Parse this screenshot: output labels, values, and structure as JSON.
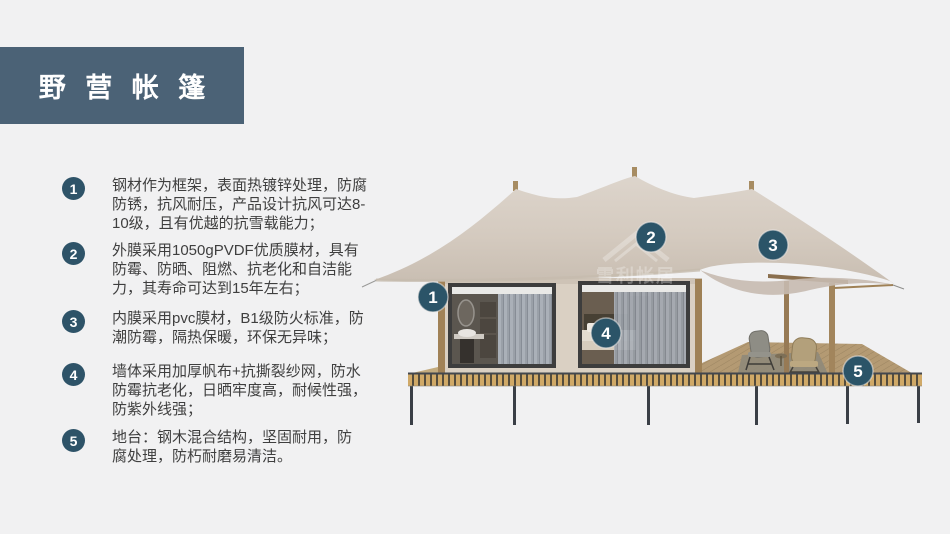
{
  "slide": {
    "title": "野 营 帐 篷",
    "background_color": "#f1f1f2",
    "title_bg_color": "#4b6276",
    "accent_color": "#2e5368"
  },
  "features": [
    {
      "num": "1",
      "text": "钢材作为框架，表面热镀锌处理，防腐\n防锈，抗风耐压，产品设计抗风可达8-\n10级，且有优越的抗雪载能力；"
    },
    {
      "num": "2",
      "text": "外膜采用1050gPVDF优质膜材，具有\n防霉、防晒、阻燃、抗老化和自洁能\n力，其寿命可达到15年左右；"
    },
    {
      "num": "3",
      "text": "内膜采用pvc膜材，B1级防火标准，防\n潮防霉，隔热保暖，环保无异味；"
    },
    {
      "num": "4",
      "text": "墙体采用加厚帆布+抗撕裂纱网，防水\n防霉抗老化，日晒牢度高，耐候性强，\n防紫外线强；"
    },
    {
      "num": "5",
      "text": "地台：钢木混合结构，坚固耐用，防\n腐处理，防朽耐磨易清洁。"
    }
  ],
  "image": {
    "watermark": "雪利帐居",
    "callouts": [
      {
        "num": "1"
      },
      {
        "num": "2"
      },
      {
        "num": "3"
      },
      {
        "num": "4"
      },
      {
        "num": "5"
      }
    ]
  }
}
